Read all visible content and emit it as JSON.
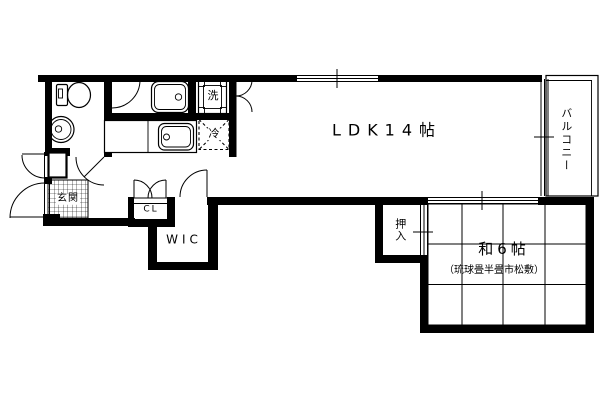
{
  "floorplan": {
    "ldk": {
      "label": "LDK14帖"
    },
    "washitsu": {
      "label": "和6帖",
      "note": "（琉球畳半畳市松敷）"
    },
    "balcony": {
      "label": "バルコニー"
    },
    "genkan": {
      "label": "玄関"
    },
    "closet": {
      "label": "CL"
    },
    "wic": {
      "label": "WIC"
    },
    "oshiire": {
      "label": "押入"
    },
    "washer": {
      "label": "洗"
    },
    "fridge": {
      "label": "冷"
    },
    "colors": {
      "line": "#000000",
      "background": "#ffffff"
    }
  }
}
